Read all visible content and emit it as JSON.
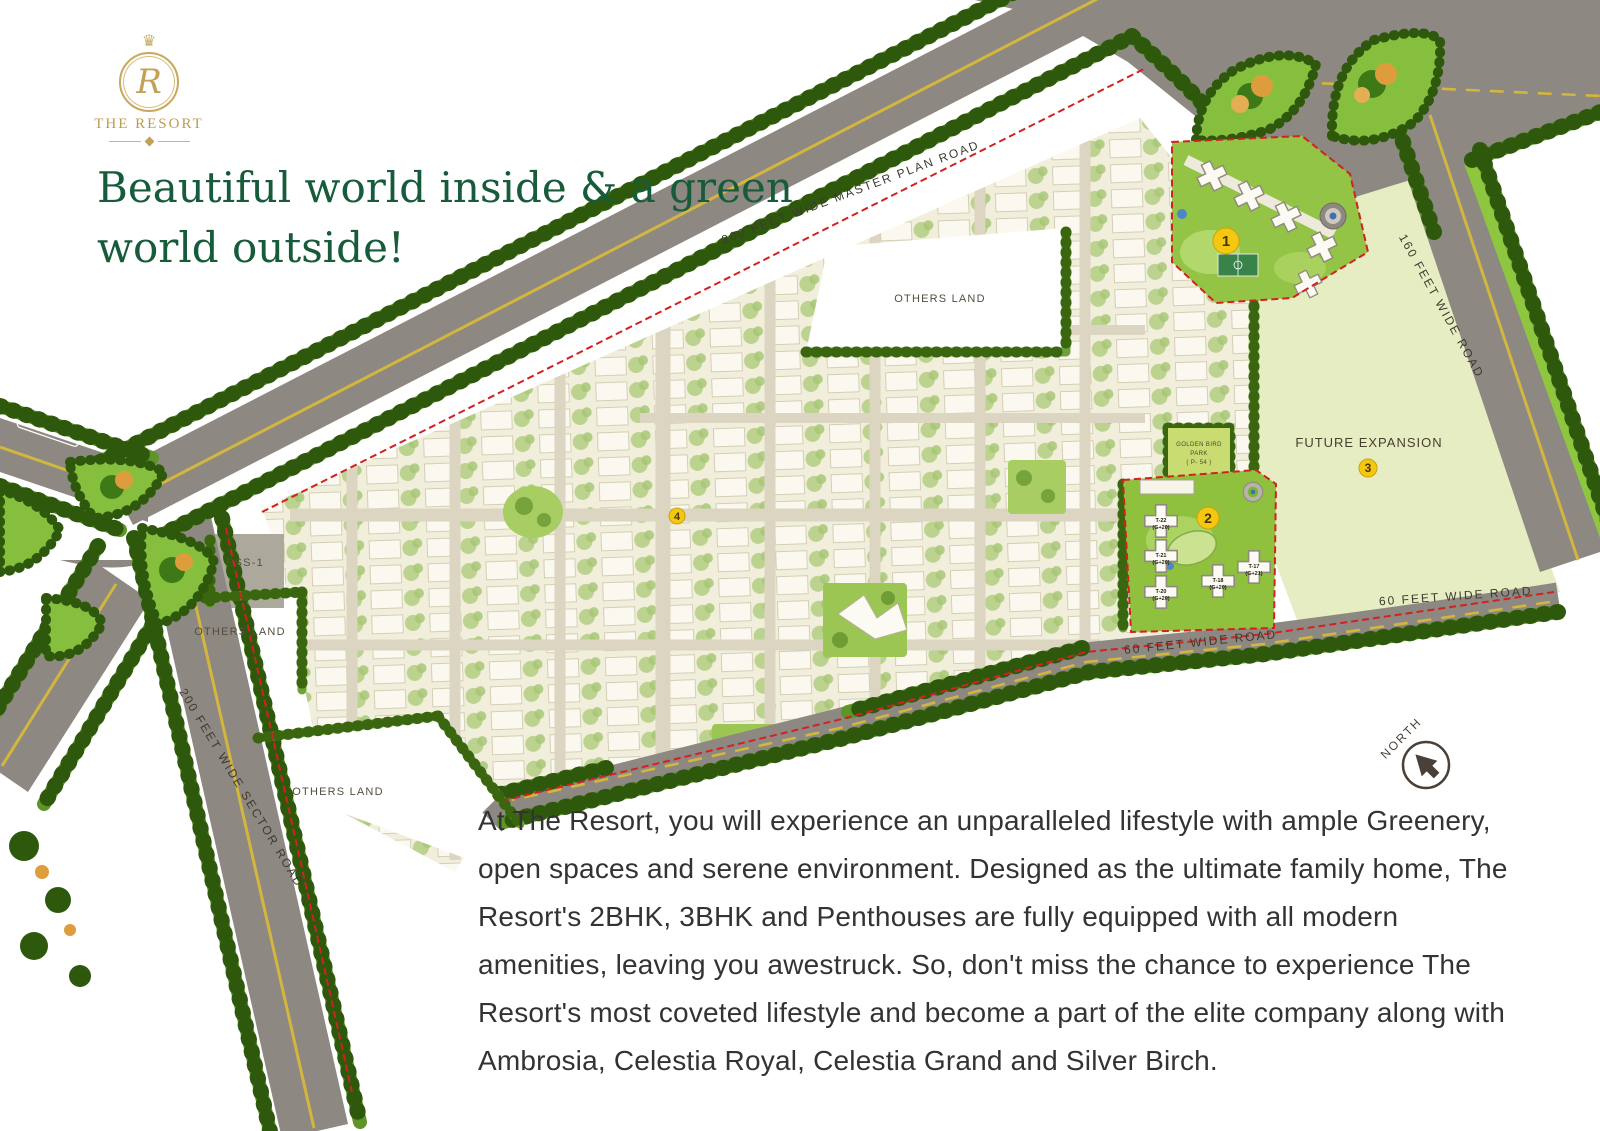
{
  "brand": {
    "crown": "♛",
    "monogram": "R",
    "name": "THE RESORT"
  },
  "headline": "Beautiful world inside & a green world outside!",
  "description": "At The Resort, you will experience an unparalleled lifestyle with ample Greenery, open spaces and serene environment. Designed as the ultimate family home, The Resort's 2BHK, 3BHK and Penthouses are fully equipped with all modern amenities, leaving you awestruck. So, don't miss the chance to experience The Resort's most coveted lifestyle and become a part of the elite company along with Ambrosia, Celestia Royal, Celestia Grand and Silver Birch.",
  "map": {
    "roads": {
      "master_plan": "200 FEET WIDE  MASTER PLAN  ROAD",
      "sector": "200 FEET WIDE SECTOR ROAD",
      "east": "160 FEET WIDE ROAD",
      "south_left": "60 FEET WIDE ROAD",
      "south_right": "60 FEET WIDE ROAD"
    },
    "areas": {
      "others_land_top": "OTHERS LAND",
      "others_land_left": "OTHERS LAND",
      "others_land_bottom": "OTHERS LAND",
      "future_expansion": "FUTURE EXPANSION",
      "ess": "ESS-1",
      "park_line1": "GOLDEN BIRD",
      "park_line2": "PARK",
      "park_line3": "( P- 54 )"
    },
    "markers": {
      "m1": "1",
      "m2": "2",
      "m3": "3",
      "m4": "4"
    },
    "towers": [
      {
        "t": "T-22",
        "f": "(G+20)"
      },
      {
        "t": "T-21",
        "f": "(G+20)"
      },
      {
        "t": "T-20",
        "f": "(G+20)"
      },
      {
        "t": "T-18",
        "f": "(G+20)"
      },
      {
        "t": "T-17",
        "f": "(G+21)"
      }
    ],
    "north": "NORTH"
  },
  "colors": {
    "brand_gold": "#c2a058",
    "headline_green": "#175c3a",
    "marker_yellow": "#f4c711",
    "road_gray": "#8d8881",
    "tree_green": "#2e590d",
    "boundary_red": "#d32121"
  }
}
